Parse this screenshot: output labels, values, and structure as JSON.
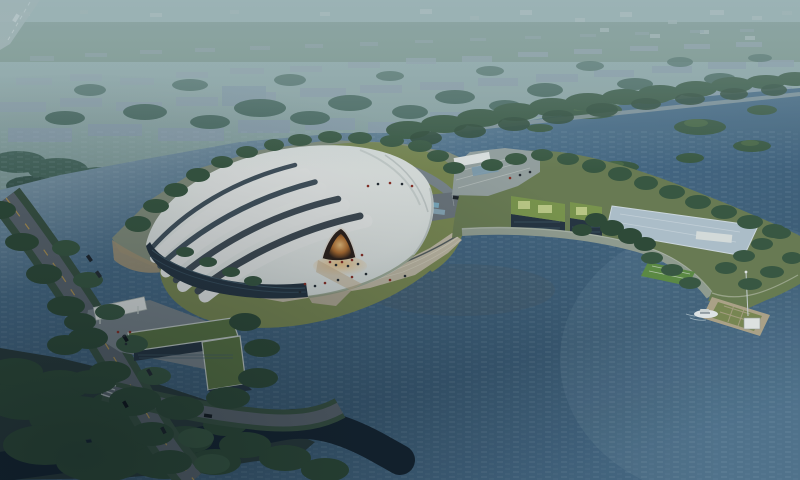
{
  "scene": {
    "type": "aerial-architectural-rendering",
    "elements": [
      "hazy background cityscape of low-rise blocks and trees",
      "tree-lined boulevard between city and wetland",
      "wetland water with wooded islands",
      "large white ribbed membrane exhibition hall with glowing amber entrance arch",
      "dark striped base facade with trees",
      "green lawn apron and fan-shaped waterfront promenade steps",
      "left pond with sandy beach edge",
      "diagonal tree-lined avenue with cars and canal bridge",
      "L-shaped green-roof gate building with white entrance canopy and plaza",
      "peninsula with two green-roof buildings, reflecting pool, parking with buses",
      "waterfront green band with sports court",
      "small pier with lawn parterre, white pavilion, mast and moored white boat",
      "large rippled lake",
      "dark canal in shadowed lower-left corner"
    ]
  },
  "palette": {
    "sky_top": "#a9bfbf",
    "sky_low": "#8da7a9",
    "city_base": "#7e9a97",
    "field_green": "#7f998b",
    "block_a": "#8ea2af",
    "block_b": "#93a6b1",
    "block_c": "#9aabb4",
    "city_tree": "#4a6b60",
    "wetland": "#9fb4bc",
    "lake_mid": "#4a6e8a",
    "lake_deep": "#3c5d77",
    "canal_dark": "#152430",
    "road_gray": "#5d676f",
    "road_light": "#7e8a90",
    "yellow_line": "#c9a24b",
    "tree_dark": "#2f4c38",
    "tree_mid": "#3a5a42",
    "tree_light": "#4d6c47",
    "lawn": "#7d8c53",
    "lawn_light": "#96a260",
    "roof_white": "#f2f4f1",
    "rib_dark": "#45545f",
    "facade_dark": "#273642",
    "glow_amber": "#eec27e",
    "glow_deep": "#b5702f",
    "promenade_tan": "#c4bda7",
    "sand": "#a59678",
    "green_roof": "#7e9a4e",
    "green_roof_light": "#c2d08a",
    "pool_blue": "#b4c6d1",
    "plaza_gray": "#9aa5a3",
    "pier_deck": "#b3a88c",
    "boat_white": "#e9efef",
    "bus_cyan": "#7fb0c4",
    "people_red": "#8e2f25",
    "court_green": "#5f8f45"
  }
}
